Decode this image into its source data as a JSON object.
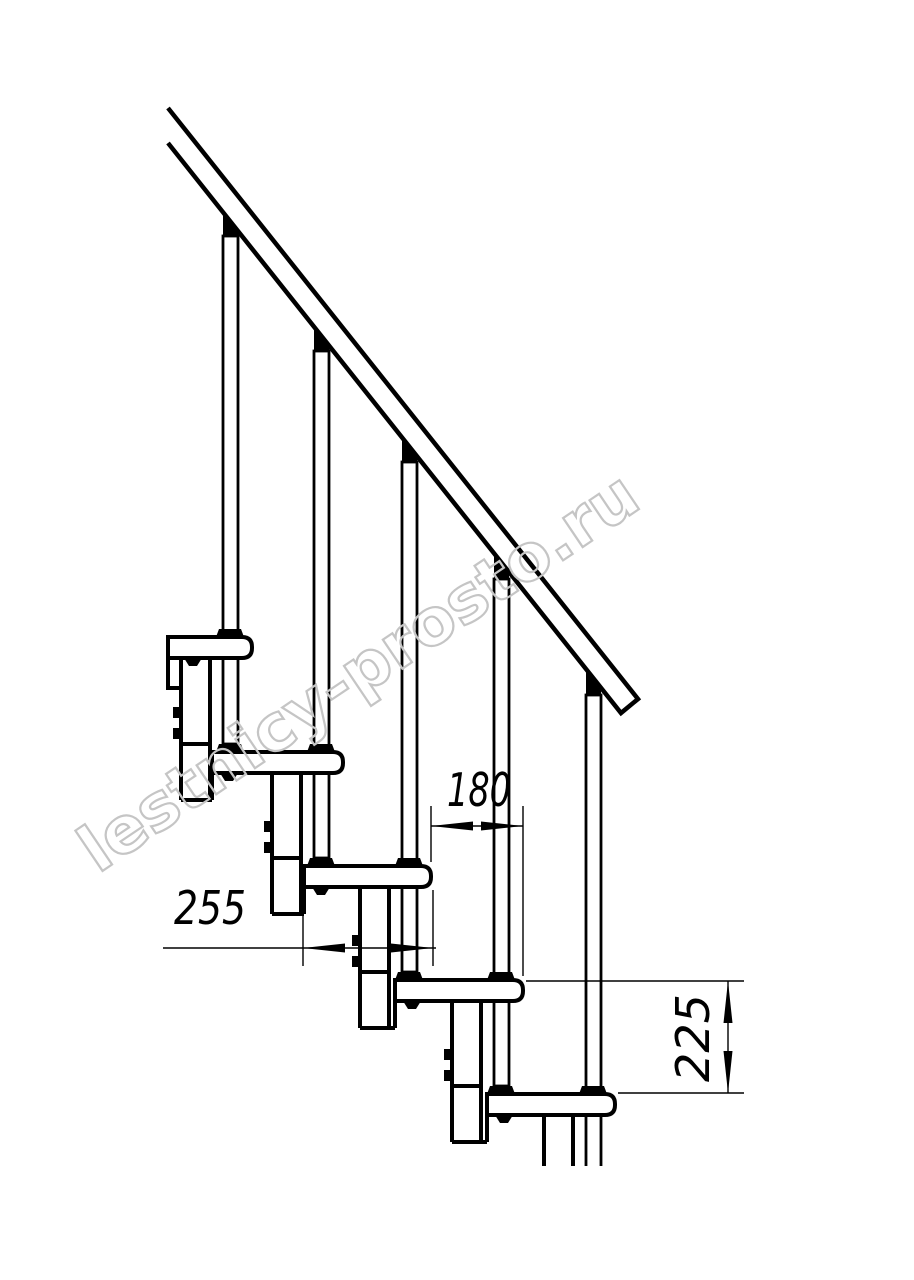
{
  "drawing": {
    "title": "modular-staircase-side-elevation",
    "dimensions": {
      "step_run": "180",
      "tread_depth": "255",
      "step_rise": "225"
    },
    "watermark": "lestnicy-prosto.ru",
    "colors": {
      "line": "#000000",
      "background": "#ffffff",
      "watermark": "#c5c5c5"
    }
  }
}
